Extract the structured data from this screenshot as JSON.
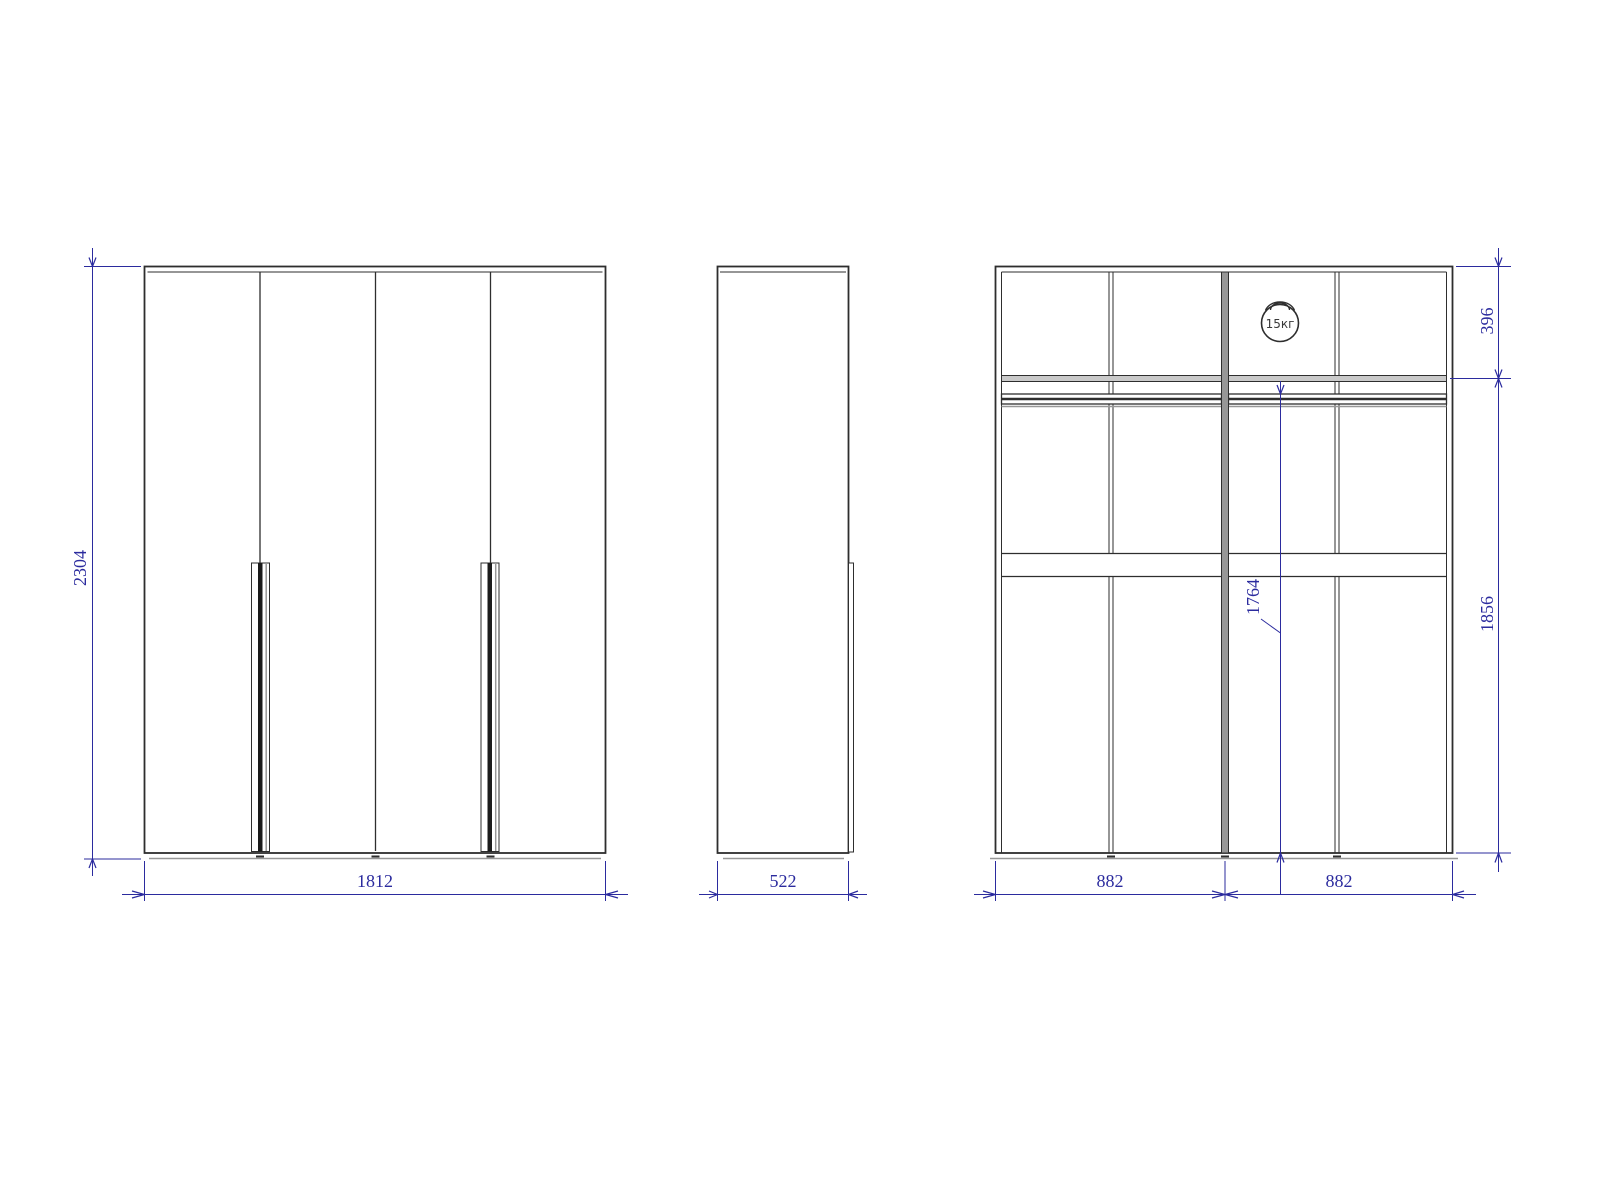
{
  "drawing": {
    "front_view": {
      "height": "2304",
      "width": "1812"
    },
    "side_view": {
      "depth": "522"
    },
    "internal_view": {
      "top_shelf_height": "396",
      "lower_section_height": "1856",
      "rod_height": "1764",
      "left_section_width": "882",
      "right_section_width": "882",
      "shelf_load_limit": "15кг"
    },
    "colors": {
      "line": "#2e2e2e",
      "dim": "#2b2b9e",
      "gray": "#979797",
      "background": "#ffffff"
    }
  }
}
